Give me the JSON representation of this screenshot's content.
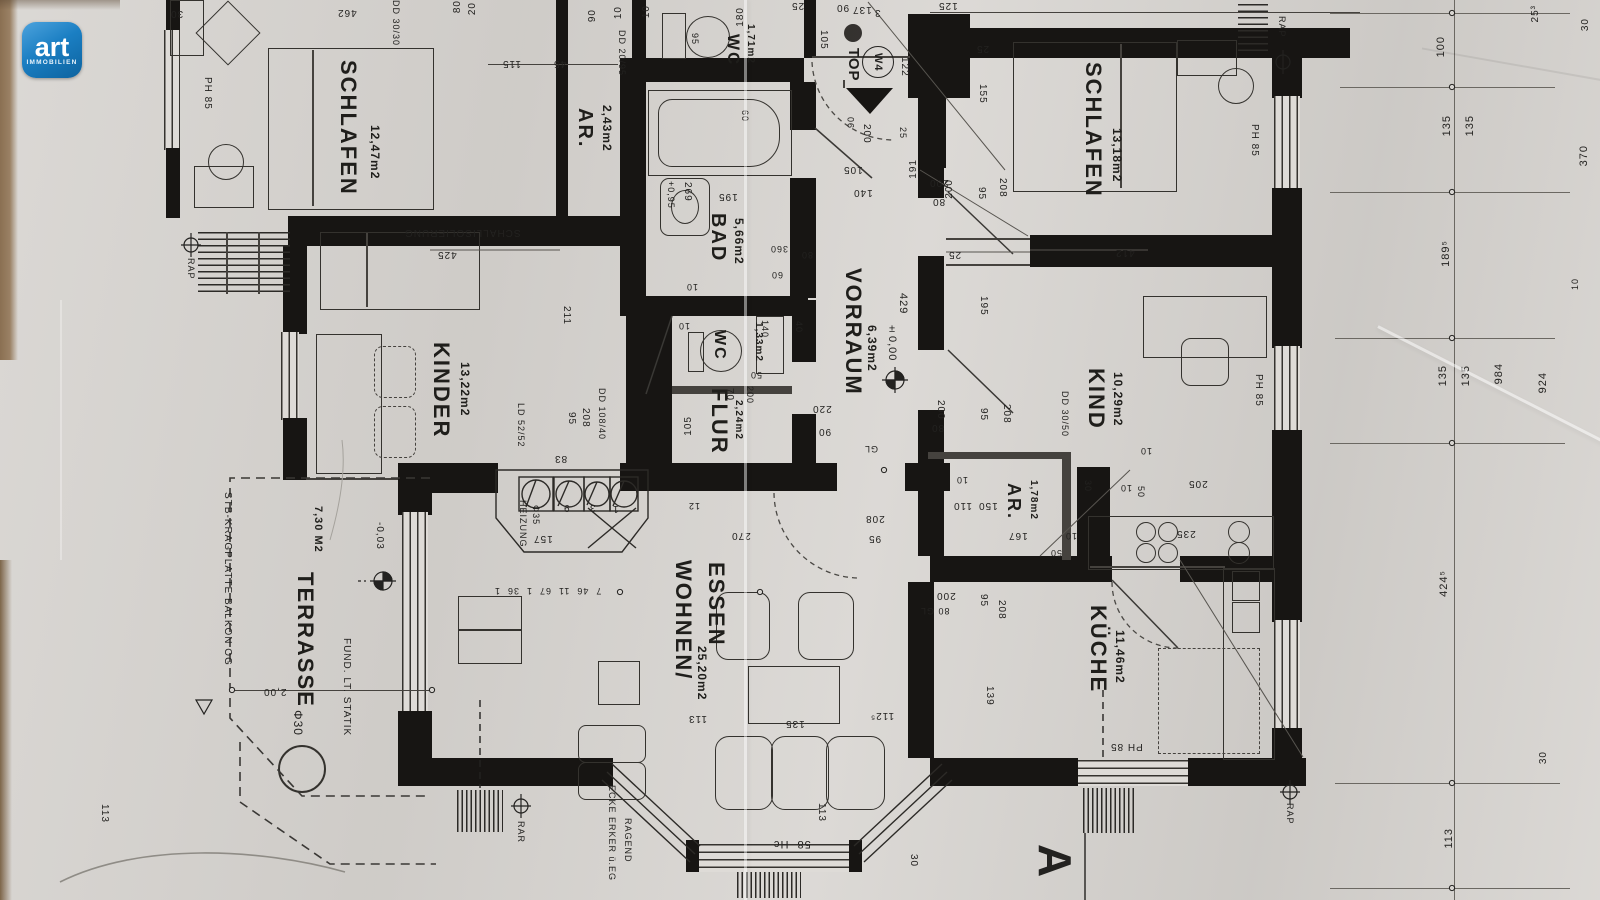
{
  "logo": {
    "brand": "art",
    "subtitle": "IMMOBILIEN",
    "color": "#1b7fc3"
  },
  "unit_marker": {
    "top_label": "TOP",
    "unit_label": "W4"
  },
  "section_marker": {
    "letter": "A"
  },
  "colors": {
    "paper": "#d7d4d0",
    "ink": "#1f1e1b",
    "wall": "#171513",
    "logo_blue": "#1b7fc3"
  },
  "rooms": [
    {
      "name": "SCHLAFEN",
      "area": "12,47m2"
    },
    {
      "name": "AR.",
      "area": "2,43m2"
    },
    {
      "name": "WC",
      "area": "1,71m2"
    },
    {
      "name": "BAD",
      "area": "5,66m2"
    },
    {
      "name": "VORRAUM",
      "area": "6,39m2"
    },
    {
      "name": "SCHLAFEN",
      "area": "13,18m2"
    },
    {
      "name": "KINDER",
      "area": "13,22m2"
    },
    {
      "name": "WC",
      "area": "1,33m2"
    },
    {
      "name": "FLUR",
      "area": "2,24m2"
    },
    {
      "name": "KIND",
      "area": "10,29m2"
    },
    {
      "name": "AR.",
      "area": "1,78m2"
    },
    {
      "name": "KÜCHE",
      "area": "11,46m2"
    },
    {
      "name": "WOHNEN/",
      "name2": "ESSEN",
      "area": "25,20m2"
    },
    {
      "name": "TERRASSE",
      "area": "7,30 M2"
    }
  ],
  "dims": [
    {
      "t": "30",
      "x": 170,
      "y": 8,
      "o": "f",
      "s": 10
    },
    {
      "t": "462",
      "x": 337,
      "y": 7,
      "o": "f",
      "s": 10
    },
    {
      "t": "DD 30/30",
      "x": 391,
      "y": 0,
      "o": "d",
      "s": 9
    },
    {
      "t": "80",
      "x": 452,
      "y": 0,
      "o": "u",
      "s": 10
    },
    {
      "t": "20",
      "x": 467,
      "y": 2,
      "o": "u",
      "s": 10
    },
    {
      "t": "115",
      "x": 502,
      "y": 58,
      "o": "f",
      "s": 10
    },
    {
      "t": "45",
      "x": 553,
      "y": 58,
      "o": "f",
      "s": 10
    },
    {
      "t": "90",
      "x": 587,
      "y": 9,
      "o": "u",
      "s": 10
    },
    {
      "t": "10",
      "x": 613,
      "y": 6,
      "o": "u",
      "s": 10
    },
    {
      "t": "10",
      "x": 641,
      "y": 5,
      "o": "u",
      "s": 10
    },
    {
      "t": "DD 20/95",
      "x": 617,
      "y": 30,
      "o": "d",
      "s": 9
    },
    {
      "t": "95",
      "x": 690,
      "y": 33,
      "o": "d",
      "s": 9
    },
    {
      "t": "180",
      "x": 735,
      "y": 7,
      "o": "u",
      "s": 10
    },
    {
      "t": "105",
      "x": 818,
      "y": 30,
      "o": "d",
      "s": 10
    },
    {
      "t": "25",
      "x": 791,
      "y": 0,
      "o": "f",
      "s": 10
    },
    {
      "t": "90",
      "x": 836,
      "y": 2,
      "o": "f",
      "s": 10
    },
    {
      "t": "137",
      "x": 852,
      "y": 4,
      "o": "f",
      "s": 10
    },
    {
      "t": "3",
      "x": 874,
      "y": 7,
      "o": "f",
      "s": 10
    },
    {
      "t": "122",
      "x": 899,
      "y": 57,
      "o": "d",
      "s": 10
    },
    {
      "t": "105",
      "x": 843,
      "y": 164,
      "o": "f",
      "s": 10
    },
    {
      "t": "140",
      "x": 853,
      "y": 187,
      "o": "f",
      "s": 10
    },
    {
      "t": "200",
      "x": 861,
      "y": 124,
      "o": "d",
      "s": 10
    },
    {
      "t": "90",
      "x": 846,
      "y": 116,
      "o": "u",
      "s": 9
    },
    {
      "t": "25",
      "x": 898,
      "y": 127,
      "o": "d",
      "s": 9
    },
    {
      "t": "191",
      "x": 908,
      "y": 159,
      "o": "u",
      "s": 10
    },
    {
      "t": "200",
      "x": 944,
      "y": 179,
      "o": "u",
      "s": 10
    },
    {
      "t": "125",
      "x": 938,
      "y": 0,
      "o": "f",
      "s": 10
    },
    {
      "t": "PH 85",
      "x": 202,
      "y": 77,
      "o": "d",
      "s": 10
    },
    {
      "t": "SCHALLISOLIERUNG",
      "x": 404,
      "y": 227,
      "o": "f",
      "s": 10
    },
    {
      "t": "425",
      "x": 437,
      "y": 249,
      "o": "f",
      "s": 10
    },
    {
      "t": "211",
      "x": 561,
      "y": 306,
      "o": "d",
      "s": 10
    },
    {
      "t": "95",
      "x": 566,
      "y": 412,
      "o": "d",
      "s": 10
    },
    {
      "t": "208",
      "x": 580,
      "y": 408,
      "o": "d",
      "s": 10
    },
    {
      "t": "DD 108/40",
      "x": 597,
      "y": 388,
      "o": "d",
      "s": 9
    },
    {
      "t": "83",
      "x": 554,
      "y": 453,
      "o": "f",
      "s": 10
    },
    {
      "t": "LD 52/52",
      "x": 516,
      "y": 403,
      "o": "d",
      "s": 9
    },
    {
      "t": "HEIZUNG",
      "x": 518,
      "y": 500,
      "o": "d",
      "s": 9
    },
    {
      "t": "Φ35",
      "x": 531,
      "y": 505,
      "o": "d",
      "s": 9
    },
    {
      "t": "9",
      "x": 563,
      "y": 502,
      "o": "f",
      "s": 10
    },
    {
      "t": "3",
      "x": 589,
      "y": 502,
      "o": "f",
      "s": 10
    },
    {
      "t": "1",
      "x": 612,
      "y": 503,
      "o": "f",
      "s": 10
    },
    {
      "t": "157",
      "x": 533,
      "y": 533,
      "o": "f",
      "s": 10
    },
    {
      "t": "7  46  11  67  1  36  1",
      "x": 494,
      "y": 586,
      "o": "f",
      "s": 9
    },
    {
      "t": "429",
      "x": 897,
      "y": 293,
      "o": "d",
      "s": 11
    },
    {
      "t": "±0,00",
      "x": 886,
      "y": 323,
      "o": "d",
      "s": 11
    },
    {
      "t": "220",
      "x": 812,
      "y": 403,
      "o": "f",
      "s": 10
    },
    {
      "t": "90",
      "x": 818,
      "y": 426,
      "o": "f",
      "s": 10
    },
    {
      "t": "GL",
      "x": 864,
      "y": 444,
      "o": "f",
      "s": 9
    },
    {
      "t": "200",
      "x": 935,
      "y": 400,
      "o": "d",
      "s": 10
    },
    {
      "t": "80",
      "x": 931,
      "y": 422,
      "o": "f",
      "s": 10
    },
    {
      "t": "95",
      "x": 978,
      "y": 408,
      "o": "d",
      "s": 10
    },
    {
      "t": "208",
      "x": 1001,
      "y": 404,
      "o": "d",
      "s": 10
    },
    {
      "t": "25",
      "x": 948,
      "y": 249,
      "o": "f",
      "s": 10
    },
    {
      "t": "195",
      "x": 978,
      "y": 296,
      "o": "d",
      "s": 10
    },
    {
      "t": "25",
      "x": 976,
      "y": 43,
      "o": "f",
      "s": 10
    },
    {
      "t": "155",
      "x": 977,
      "y": 84,
      "o": "d",
      "s": 10
    },
    {
      "t": "208",
      "x": 997,
      "y": 178,
      "o": "d",
      "s": 10
    },
    {
      "t": "95",
      "x": 976,
      "y": 187,
      "o": "d",
      "s": 10
    },
    {
      "t": "200",
      "x": 929,
      "y": 177,
      "o": "f",
      "s": 10
    },
    {
      "t": "80",
      "x": 932,
      "y": 196,
      "o": "f",
      "s": 10
    },
    {
      "t": "412",
      "x": 1115,
      "y": 247,
      "o": "f",
      "s": 10
    },
    {
      "t": "PH 85",
      "x": 1249,
      "y": 124,
      "o": "d",
      "s": 10
    },
    {
      "t": "DD 30/50",
      "x": 1060,
      "y": 391,
      "o": "d",
      "s": 9
    },
    {
      "t": "10",
      "x": 1140,
      "y": 446,
      "o": "f",
      "s": 9
    },
    {
      "t": "205",
      "x": 1188,
      "y": 478,
      "o": "f",
      "s": 10
    },
    {
      "t": "50",
      "x": 1136,
      "y": 486,
      "o": "d",
      "s": 9
    },
    {
      "t": "10",
      "x": 1120,
      "y": 483,
      "o": "f",
      "s": 9
    },
    {
      "t": "30",
      "x": 1083,
      "y": 480,
      "o": "d",
      "s": 9
    },
    {
      "t": "PH 85",
      "x": 1253,
      "y": 374,
      "o": "d",
      "s": 10
    },
    {
      "t": "110",
      "x": 953,
      "y": 500,
      "o": "f",
      "s": 10
    },
    {
      "t": "150",
      "x": 978,
      "y": 500,
      "o": "f",
      "s": 10
    },
    {
      "t": "10",
      "x": 956,
      "y": 475,
      "o": "f",
      "s": 9
    },
    {
      "t": "167",
      "x": 1008,
      "y": 530,
      "o": "f",
      "s": 10
    },
    {
      "t": "50",
      "x": 1050,
      "y": 548,
      "o": "f",
      "s": 9
    },
    {
      "t": "10",
      "x": 1065,
      "y": 531,
      "o": "f",
      "s": 9
    },
    {
      "t": "139",
      "x": 984,
      "y": 686,
      "o": "d",
      "s": 10
    },
    {
      "t": "200",
      "x": 936,
      "y": 590,
      "o": "f",
      "s": 10
    },
    {
      "t": "80 GL",
      "x": 920,
      "y": 606,
      "o": "f",
      "s": 9
    },
    {
      "t": "95",
      "x": 978,
      "y": 594,
      "o": "d",
      "s": 10
    },
    {
      "t": "208",
      "x": 996,
      "y": 600,
      "o": "d",
      "s": 10
    },
    {
      "t": "235",
      "x": 1176,
      "y": 528,
      "o": "f",
      "s": 10
    },
    {
      "t": "PH 85",
      "x": 1110,
      "y": 741,
      "o": "f",
      "s": 10
    },
    {
      "t": "270",
      "x": 731,
      "y": 530,
      "o": "f",
      "s": 10
    },
    {
      "t": "208",
      "x": 865,
      "y": 513,
      "o": "f",
      "s": 10
    },
    {
      "t": "95",
      "x": 868,
      "y": 533,
      "o": "f",
      "s": 10
    },
    {
      "t": "113",
      "x": 688,
      "y": 713,
      "o": "f",
      "s": 10
    },
    {
      "t": "135",
      "x": 785,
      "y": 718,
      "o": "f",
      "s": 10
    },
    {
      "t": "112⁵",
      "x": 870,
      "y": 710,
      "o": "f",
      "s": 10
    },
    {
      "t": "12",
      "x": 688,
      "y": 501,
      "o": "f",
      "s": 9
    },
    {
      "t": "113",
      "x": 816,
      "y": 803,
      "o": "d",
      "s": 10
    },
    {
      "t": "58  Hc",
      "x": 773,
      "y": 838,
      "o": "f",
      "s": 11
    },
    {
      "t": "30",
      "x": 908,
      "y": 854,
      "o": "d",
      "s": 10
    },
    {
      "t": "ECKE ERKER ü.EG",
      "x": 607,
      "y": 785,
      "o": "d",
      "s": 9
    },
    {
      "t": "RAGEND",
      "x": 623,
      "y": 818,
      "o": "d",
      "s": 9
    },
    {
      "t": "Φ30",
      "x": 291,
      "y": 710,
      "o": "d",
      "s": 12
    },
    {
      "t": "STB-KRAGPLATTE BALKON OG",
      "x": 222,
      "y": 492,
      "o": "d",
      "s": 10
    },
    {
      "t": "FUND. LT. STATIK",
      "x": 341,
      "y": 638,
      "o": "d",
      "s": 10
    },
    {
      "t": "2,00",
      "x": 263,
      "y": 686,
      "o": "f",
      "s": 10
    },
    {
      "t": "-0,03",
      "x": 374,
      "y": 522,
      "o": "d",
      "s": 10
    },
    {
      "t": "113",
      "x": 99,
      "y": 804,
      "o": "d",
      "s": 10
    },
    {
      "t": "RAP",
      "x": 186,
      "y": 258,
      "o": "d",
      "s": 9
    },
    {
      "t": "RAP",
      "x": 1277,
      "y": 16,
      "o": "d",
      "s": 9
    },
    {
      "t": "RAP",
      "x": 1285,
      "y": 803,
      "o": "d",
      "s": 9
    },
    {
      "t": "RAR",
      "x": 516,
      "y": 821,
      "o": "d",
      "s": 9
    },
    {
      "t": "100",
      "x": 1435,
      "y": 36,
      "o": "u",
      "s": 11
    },
    {
      "t": "135",
      "x": 1441,
      "y": 115,
      "o": "u",
      "s": 11
    },
    {
      "t": "135",
      "x": 1464,
      "y": 115,
      "o": "u",
      "s": 11
    },
    {
      "t": "189⁵",
      "x": 1440,
      "y": 240,
      "o": "u",
      "s": 11
    },
    {
      "t": "135",
      "x": 1437,
      "y": 365,
      "o": "u",
      "s": 11
    },
    {
      "t": "135",
      "x": 1460,
      "y": 365,
      "o": "u",
      "s": 11
    },
    {
      "t": "984",
      "x": 1493,
      "y": 363,
      "o": "u",
      "s": 11
    },
    {
      "t": "924",
      "x": 1537,
      "y": 372,
      "o": "u",
      "s": 11
    },
    {
      "t": "370",
      "x": 1578,
      "y": 145,
      "o": "u",
      "s": 11
    },
    {
      "t": "25³",
      "x": 1530,
      "y": 5,
      "o": "u",
      "s": 10
    },
    {
      "t": "30",
      "x": 1580,
      "y": 18,
      "o": "u",
      "s": 10
    },
    {
      "t": "10",
      "x": 1570,
      "y": 278,
      "o": "u",
      "s": 9
    },
    {
      "t": "424⁵",
      "x": 1438,
      "y": 570,
      "o": "u",
      "s": 11
    },
    {
      "t": "30",
      "x": 1538,
      "y": 751,
      "o": "u",
      "s": 10
    },
    {
      "t": "113",
      "x": 1443,
      "y": 828,
      "o": "u",
      "s": 11
    },
    {
      "t": "+0,95",
      "x": 666,
      "y": 181,
      "o": "d",
      "s": 9
    },
    {
      "t": "269",
      "x": 682,
      "y": 182,
      "o": "d",
      "s": 10
    },
    {
      "t": "195",
      "x": 718,
      "y": 191,
      "o": "f",
      "s": 10
    },
    {
      "t": "60",
      "x": 740,
      "y": 110,
      "o": "d",
      "s": 9
    },
    {
      "t": "360",
      "x": 770,
      "y": 244,
      "o": "f",
      "s": 9
    },
    {
      "t": "80",
      "x": 801,
      "y": 250,
      "o": "f",
      "s": 9
    },
    {
      "t": "60",
      "x": 771,
      "y": 270,
      "o": "f",
      "s": 9
    },
    {
      "t": "10",
      "x": 686,
      "y": 282,
      "o": "f",
      "s": 9
    },
    {
      "t": "10",
      "x": 678,
      "y": 321,
      "o": "f",
      "s": 9
    },
    {
      "t": "140",
      "x": 760,
      "y": 320,
      "o": "d",
      "s": 9
    },
    {
      "t": "40",
      "x": 794,
      "y": 321,
      "o": "d",
      "s": 9
    },
    {
      "t": "50",
      "x": 750,
      "y": 370,
      "o": "f",
      "s": 9
    },
    {
      "t": "200",
      "x": 745,
      "y": 386,
      "o": "d",
      "s": 9
    },
    {
      "t": "70",
      "x": 724,
      "y": 388,
      "o": "d",
      "s": 10
    },
    {
      "t": "105",
      "x": 683,
      "y": 416,
      "o": "u",
      "s": 10
    }
  ]
}
